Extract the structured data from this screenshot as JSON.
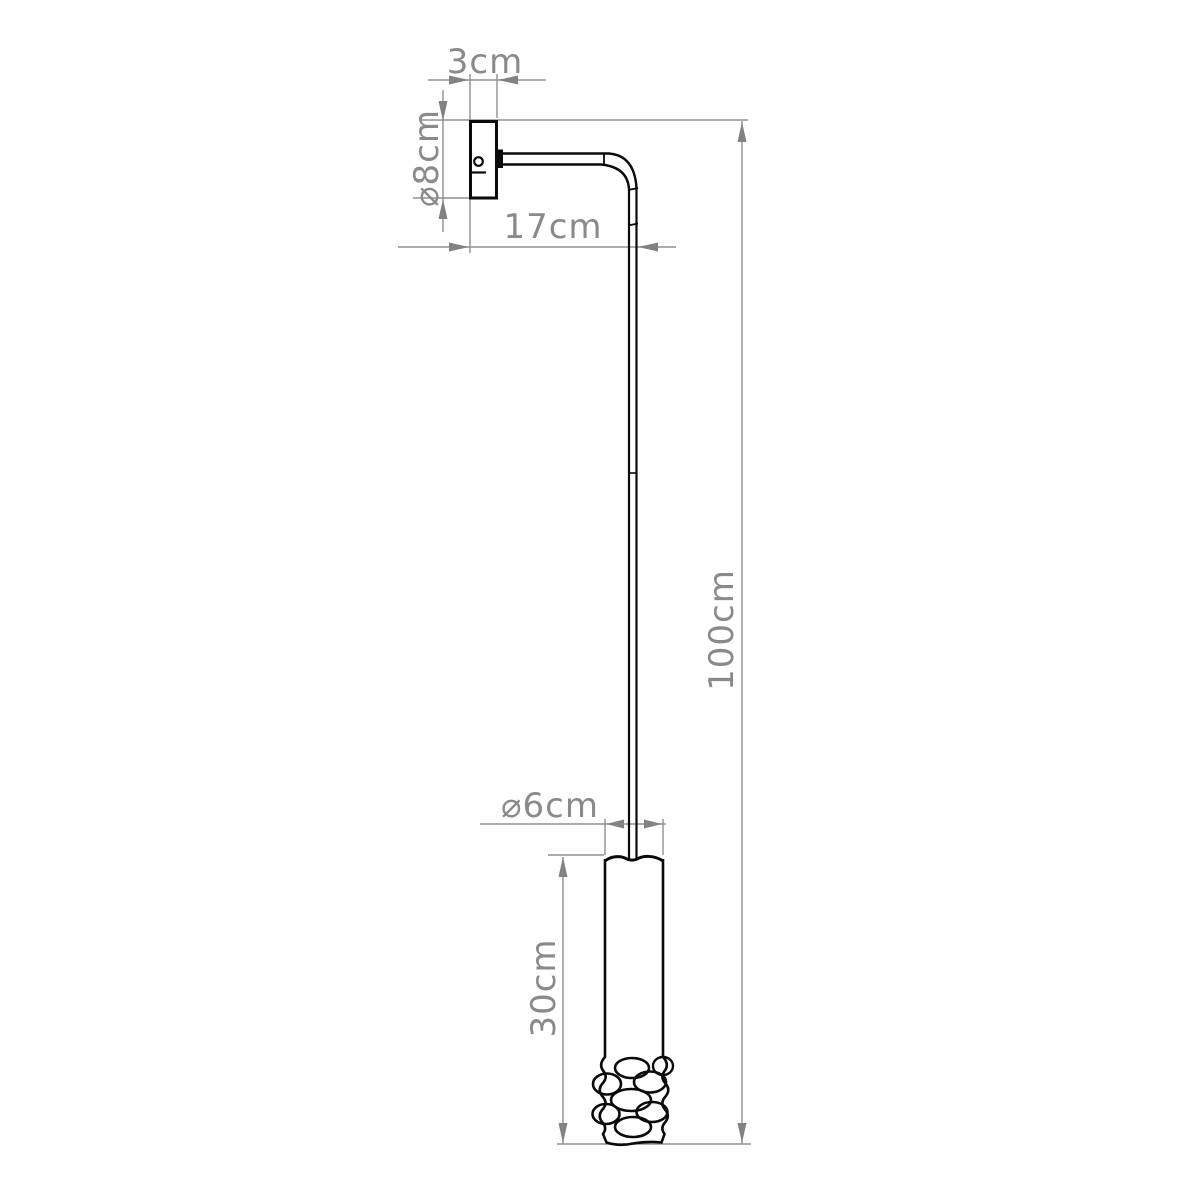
{
  "drawing_title": "wall-lamp-dimension-drawing",
  "labels": {
    "plate_depth": "3cm",
    "plate_diameter": "⌀8cm",
    "arm_length": "17cm",
    "overall_drop": "100cm",
    "shade_diameter": "⌀6cm",
    "shade_height": "30cm"
  },
  "colors": {
    "drawing_line": "#0a0a0a",
    "dimension_line": "#909090",
    "dimension_text": "#8a8a8a",
    "background": "#ffffff"
  }
}
